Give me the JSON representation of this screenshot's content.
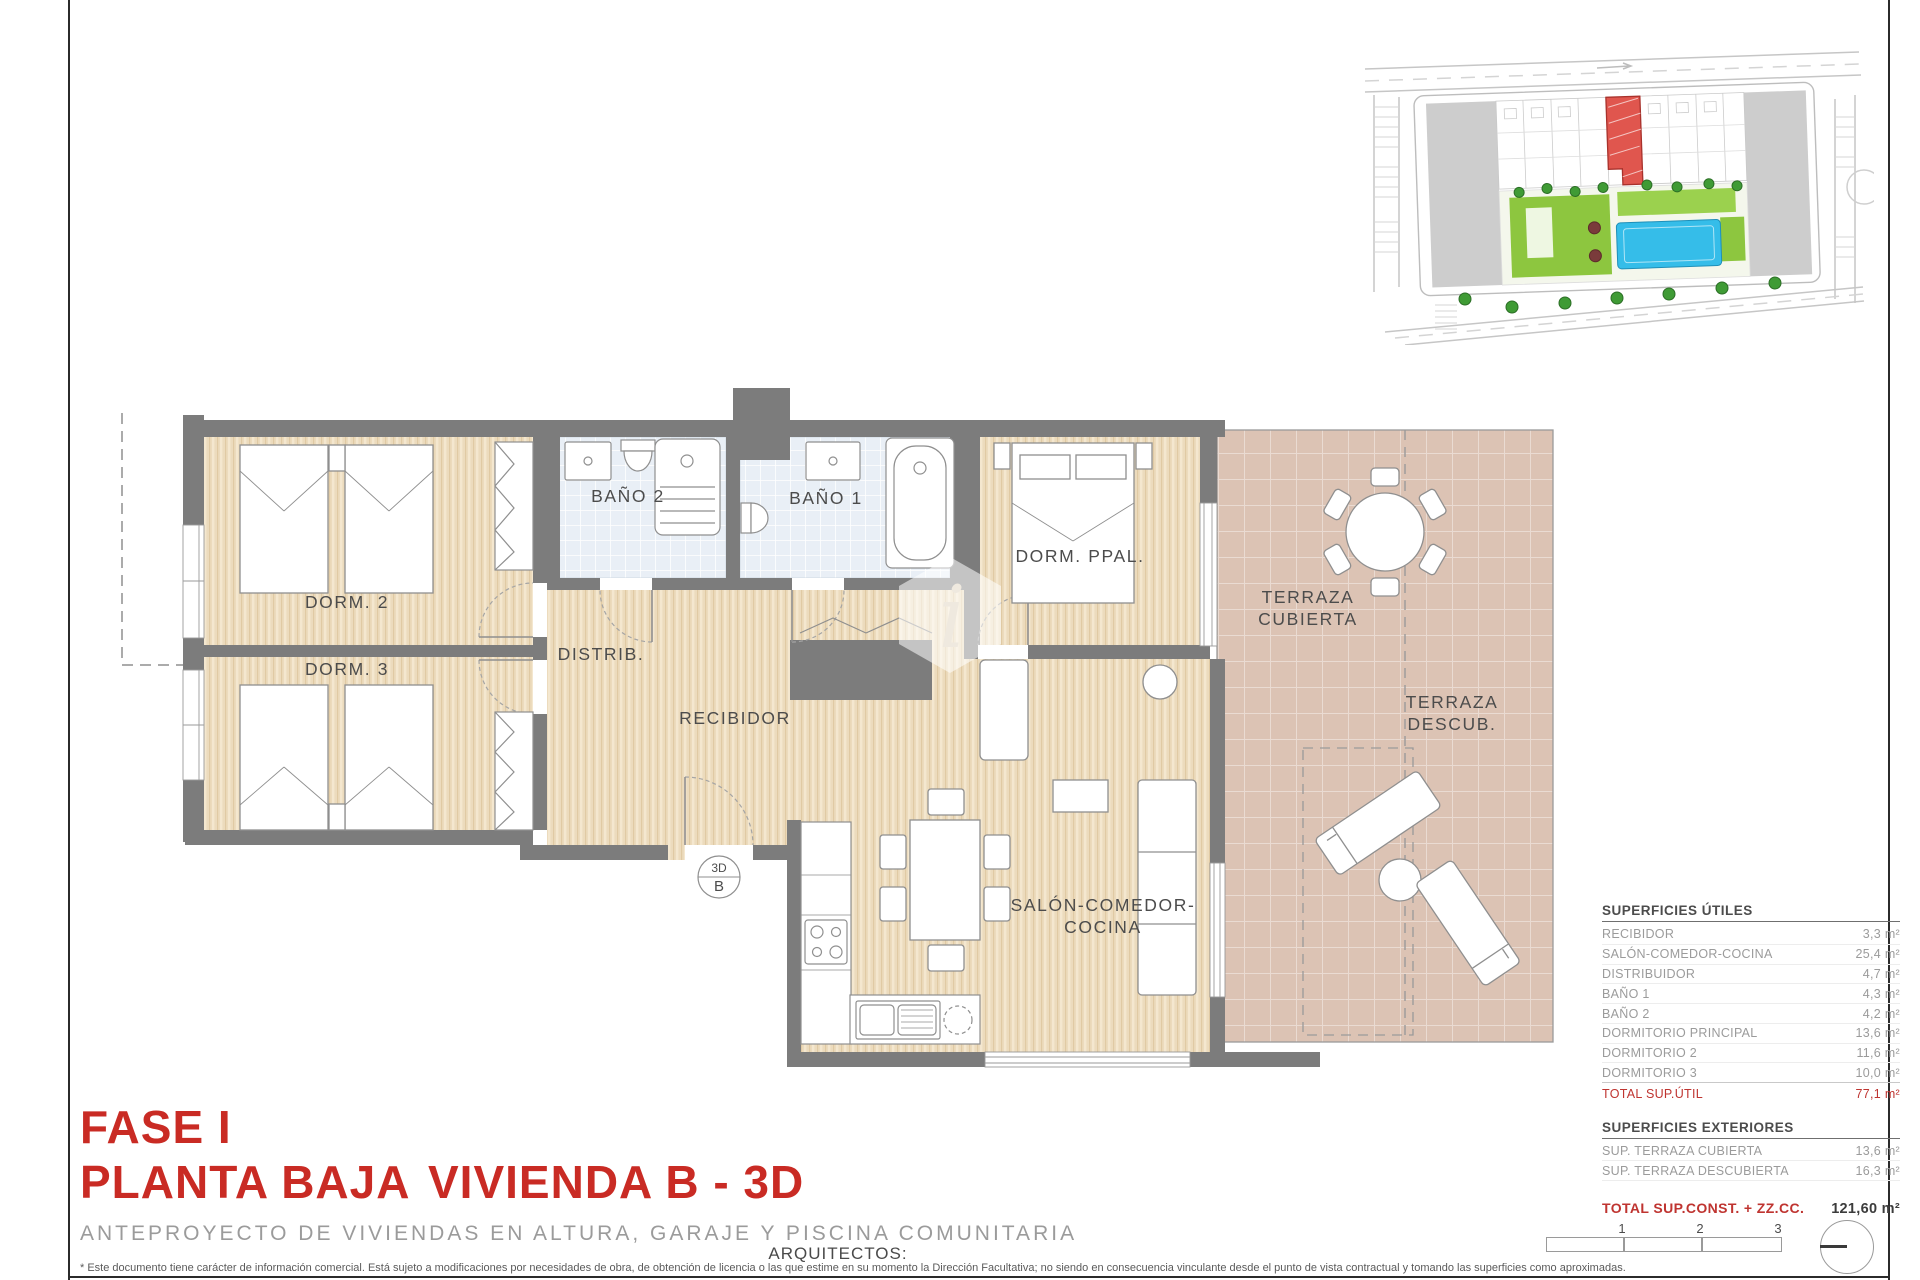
{
  "title_block": {
    "fase": "FASE I",
    "planta": "PLANTA BAJA",
    "vivienda": "VIVIENDA B - 3D",
    "subtitle": "ANTEPROYECTO DE VIVIENDAS EN ALTURA, GARAJE Y PISCINA COMUNITARIA",
    "architects_label": "ARQUITECTOS:"
  },
  "footer": {
    "disclaimer": "* Este documento tiene carácter de información comercial. Está sujeto a modificaciones por necesidades de obra, de obtención de licencia o las que estime en su momento la Dirección Facultativa; no siendo en consecuencia vinculante desde el punto de vista contractual y tomando las superficies como aproximadas."
  },
  "plan": {
    "labels": {
      "dorm2": "DORM. 2",
      "dorm3": "DORM. 3",
      "bano2": "BAÑO 2",
      "bano1": "BAÑO 1",
      "dorm_ppal": "DORM. PPAL.",
      "distrib": "DISTRIB.",
      "recibidor": "RECIBIDOR",
      "salon_line1": "SALÓN-COMEDOR-",
      "salon_line2": "COCINA",
      "terraza_cubierta_line1": "TERRAZA",
      "terraza_cubierta_line2": "CUBIERTA",
      "terraza_descub_line1": "TERRAZA",
      "terraza_descub_line2": "DESCUB.",
      "marker_top": "3D",
      "marker_bottom": "B"
    }
  },
  "tables": {
    "utiles": {
      "title": "SUPERFICIES ÚTILES",
      "rows": [
        {
          "label": "RECIBIDOR",
          "value": "3,3 m²"
        },
        {
          "label": "SALÓN-COMEDOR-COCINA",
          "value": "25,4 m²"
        },
        {
          "label": "DISTRIBUIDOR",
          "value": "4,7 m²"
        },
        {
          "label": "BAÑO 1",
          "value": "4,3 m²"
        },
        {
          "label": "BAÑO 2",
          "value": "4,2 m²"
        },
        {
          "label": "DORMITORIO PRINCIPAL",
          "value": "13,6 m²"
        },
        {
          "label": "DORMITORIO 2",
          "value": "11,6 m²"
        },
        {
          "label": "DORMITORIO 3",
          "value": "10,0 m²"
        }
      ],
      "total": {
        "label": "TOTAL SUP.ÚTIL",
        "value": "77,1 m²"
      }
    },
    "exteriores": {
      "title": "SUPERFICIES EXTERIORES",
      "rows": [
        {
          "label": "SUP. TERRAZA CUBIERTA",
          "value": "13,6 m²"
        },
        {
          "label": "SUP. TERRAZA DESCUBIERTA",
          "value": "16,3 m²"
        }
      ]
    },
    "total_const": {
      "label": "TOTAL SUP.CONST. + ZZ.CC.",
      "value": "121,60 m²"
    }
  },
  "scale_bar": {
    "labels": [
      "1",
      "2",
      "3"
    ]
  },
  "colors": {
    "accent_red": "#c92b24",
    "totals_red": "#bf3430",
    "wall_gray": "#7c7c7c",
    "floor_beige": "#ecdbbd",
    "terrace_pink": "#dcc3b4",
    "bath_blue": "#e9eff6",
    "site_highlight_red": "#e0564e",
    "pool_blue": "#35bde9",
    "garden_green": "#8dc63f"
  }
}
